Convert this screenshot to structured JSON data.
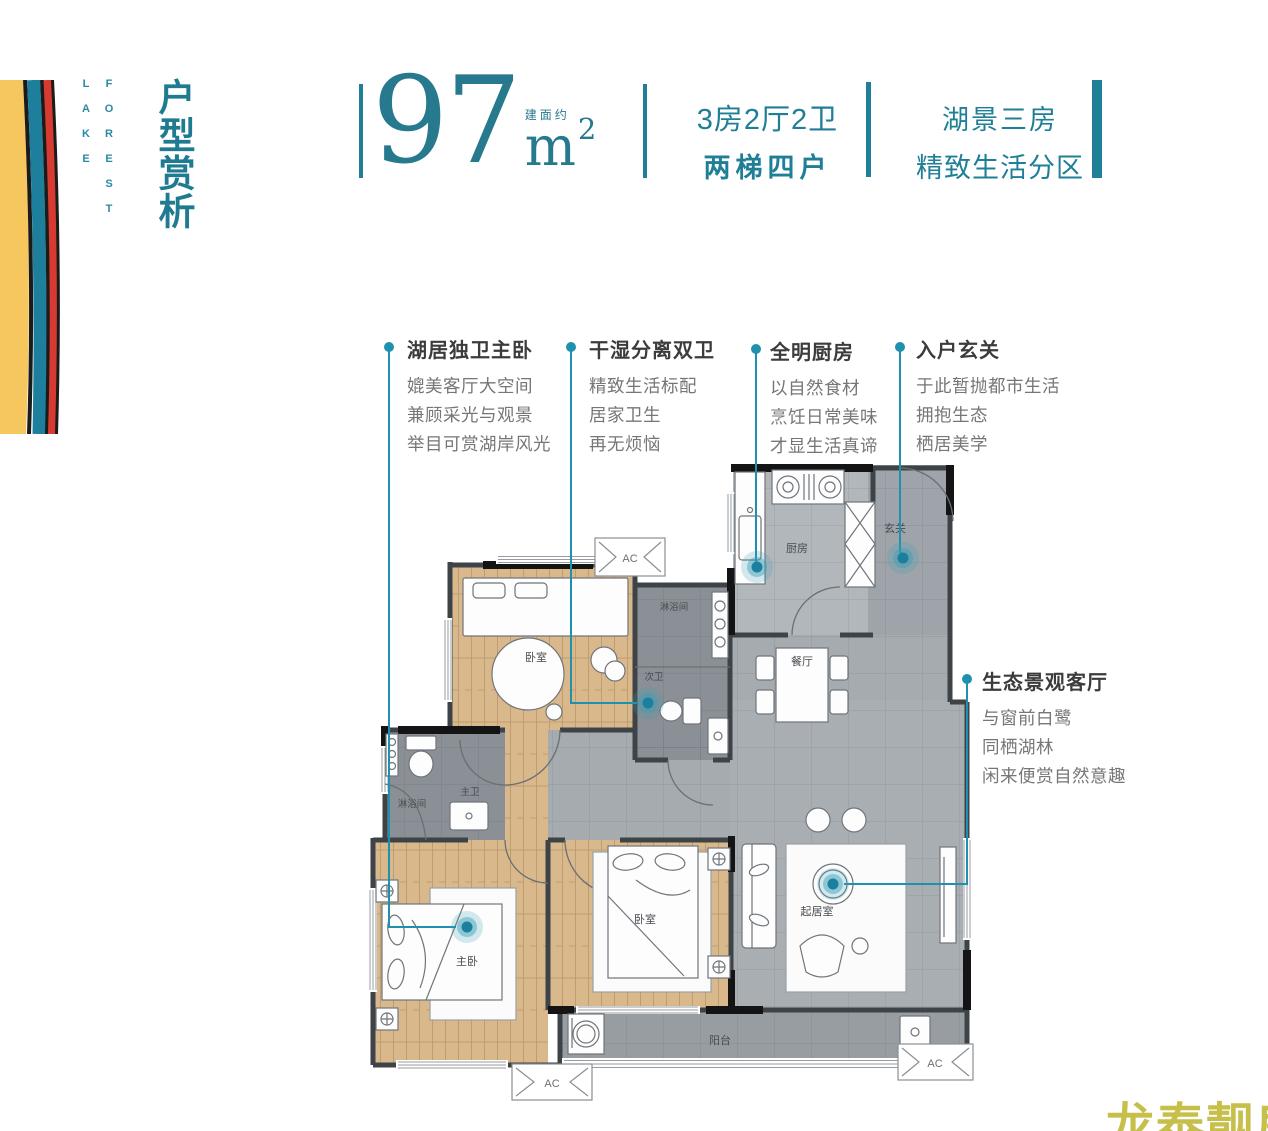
{
  "brand": {
    "lake_word": "LAKE",
    "forest_word": "FOREST",
    "page_title": "户型赏析",
    "watermark": "龙泰靓房"
  },
  "header": {
    "area_label": "建面约",
    "area_value": "97",
    "area_unit": "m",
    "area_sup": "2",
    "spec_layout": "3房2厅2卫",
    "spec_elevator": "两梯四户",
    "tag_line1": "湖景三房",
    "tag_line2": "精致生活分区"
  },
  "callouts": [
    {
      "title": "湖居独卫主卧",
      "lines": [
        "媲美客厅大空间",
        "兼顾采光与观景",
        "举目可赏湖岸风光"
      ]
    },
    {
      "title": "干湿分离双卫",
      "lines": [
        "精致生活标配",
        "居家卫生",
        "再无烦恼"
      ]
    },
    {
      "title": "全明厨房",
      "lines": [
        "以自然食材",
        "烹饪日常美味",
        "才显生活真谛"
      ]
    },
    {
      "title": "入户玄关",
      "lines": [
        "于此暂抛都市生活",
        "拥抱生态",
        "栖居美学"
      ]
    },
    {
      "title": "生态景观客厅",
      "lines": [
        "与窗前白鹭",
        "同栖湖林",
        "闲来便赏自然意趣"
      ]
    }
  ],
  "floor_plan": {
    "ac_label": "AC",
    "rooms": [
      "厨房",
      "玄关",
      "餐厅",
      "起居室",
      "阳台",
      "卧室",
      "淋浴间",
      "次卫",
      "主卫",
      "淋浴间",
      "主卧",
      "卧室"
    ]
  },
  "colors": {
    "accent": "#1f7f96",
    "marker": "#1f90ad",
    "wood_floor": "#d9b98c",
    "tile_floor": "#a9aeb3",
    "wall": "#3e4347",
    "stripe_yellow": "#f6c75e",
    "stripe_teal": "#1d7f9b",
    "stripe_red": "#d63a31",
    "watermark": "#c6bf4a"
  }
}
